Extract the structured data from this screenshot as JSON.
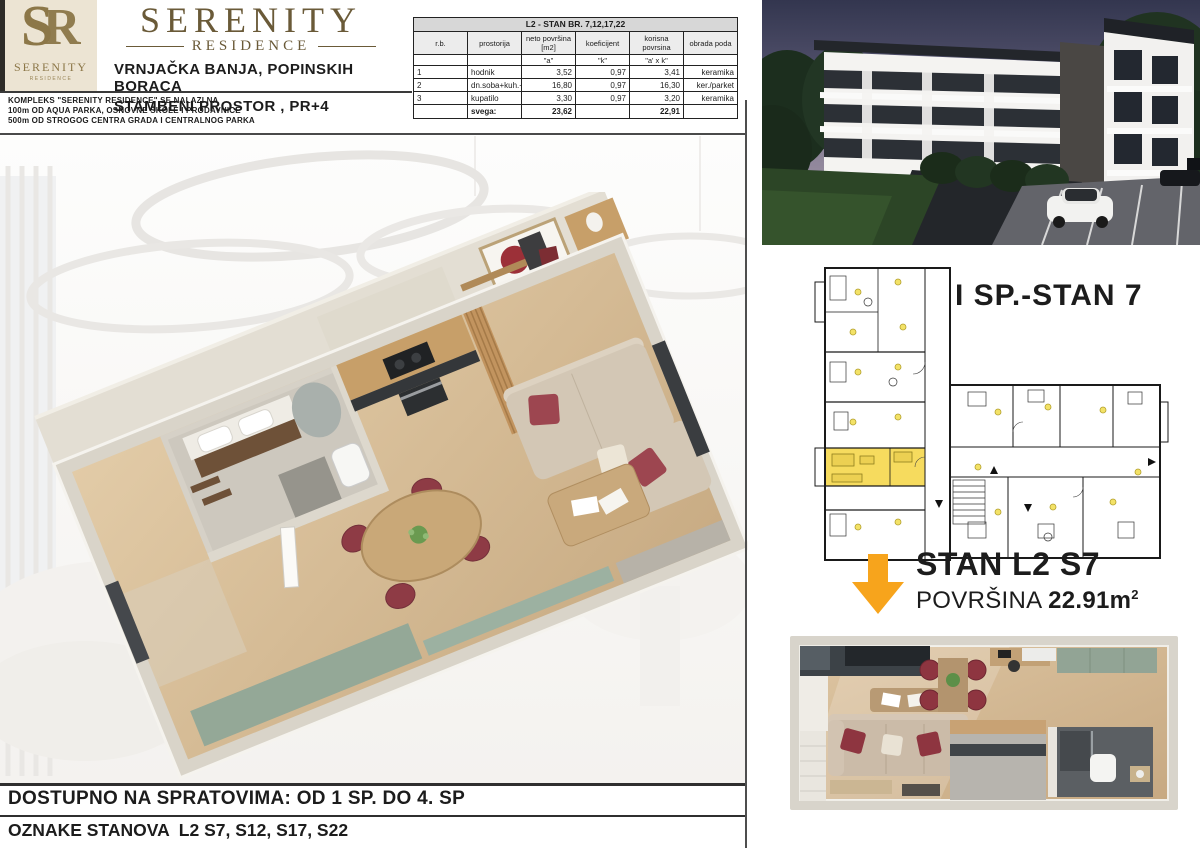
{
  "colors": {
    "gold": "#8c7748",
    "title_bronze": "#6a5a38",
    "text_dark": "#1c1c1c",
    "accent_orange": "#F7A41C",
    "plan_highlight_yellow": "#F6DB5E",
    "table_title_bg": "#d7d7d7"
  },
  "brand": {
    "monogram_s": "S",
    "monogram_r": "R",
    "logo_name": "SERENITY",
    "logo_sub": "RESIDENCE"
  },
  "header": {
    "title": "SERENITY",
    "subtitle": "RESIDENCE",
    "address1": "VRNJAČKA BANJA, POPINSKIH BORACA",
    "address2": "STAMBENI PROSTOR , PR+4",
    "info1": "KOMPLEKS \"SERENITY RESIDENCE\" SE NALAZI NA",
    "info2": "100m OD AQUA PARKA, OSNOVNE ŠKOLE I PRODAVNICE",
    "info3": "500m OD STROGOG CENTRA GRADA I CENTRALNOG PARKA"
  },
  "area_table": {
    "title": "L2 - STAN BR. 7,12,17,22",
    "columns": [
      "r.b.",
      "prostorija",
      "neto površina [m2]",
      "koeficijent",
      "korisna povrsina",
      "obrada poda"
    ],
    "sub_headers": [
      "",
      "",
      "\"a\"",
      "\"k\"",
      "\"a' x k\"",
      ""
    ],
    "rows": [
      {
        "num": "1",
        "room": "hodnik",
        "neto": "3,52",
        "koef": "0,97",
        "korisna": "3,41",
        "pod": "keramika"
      },
      {
        "num": "2",
        "room": "dn.soba+kuh.+trp.",
        "neto": "16,80",
        "koef": "0,97",
        "korisna": "16,30",
        "pod": "ker./parket"
      },
      {
        "num": "3",
        "room": "kupatilo",
        "neto": "3,30",
        "koef": "0,97",
        "korisna": "3,20",
        "pod": "keramika"
      }
    ],
    "total": {
      "label": "svega:",
      "neto": "23,62",
      "koef": "",
      "korisna": "22,91",
      "pod": ""
    }
  },
  "plan": {
    "label": "I SP.-STAN 7"
  },
  "unit": {
    "name": "STAN L2 S7",
    "area_label": "POVRŠINA",
    "area_value": "22.91m",
    "area_sup": "2"
  },
  "footer": {
    "line1": "DOSTUPNO NA SPRATOVIMA: OD 1 SP. DO 4. SP",
    "line2": "OZNAKE STANOVA  L2 S7, S12, S17, S22"
  },
  "icons": {
    "down_arrow": "▼"
  }
}
